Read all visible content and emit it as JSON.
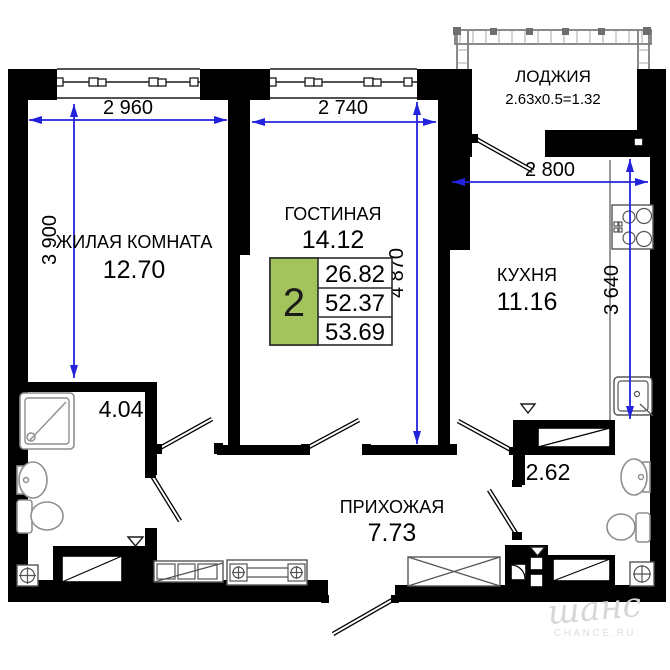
{
  "rooms": {
    "living": {
      "name": "ЖИЛАЯ КОМНАТА",
      "area": "12.70"
    },
    "lounge": {
      "name": "ГОСТИНАЯ",
      "area": "14.12"
    },
    "loggia": {
      "name": "ЛОДЖИЯ",
      "area": "2.63x0.5=1.32"
    },
    "kitchen": {
      "name": "КУХНЯ",
      "area": "11.16"
    },
    "hallway": {
      "name": "ПРИХОЖАЯ",
      "area": "7.73"
    },
    "bathroom": {
      "area": "4.04"
    },
    "wc": {
      "area": "2.62"
    }
  },
  "dimensions": {
    "living_width": "2 960",
    "lounge_width": "2 740",
    "kitchen_width": "2 800",
    "living_depth": "3 900",
    "lounge_depth": "4 870",
    "kitchen_depth": "3 640"
  },
  "summary": {
    "rooms": "2",
    "values": [
      "26.82",
      "52.37",
      "53.69"
    ]
  },
  "watermark": {
    "logo": "шанс",
    "site": "CHANCE.RU"
  },
  "colors": {
    "accent_green": "#a3c45c",
    "dimension_blue": "#2323dd"
  }
}
